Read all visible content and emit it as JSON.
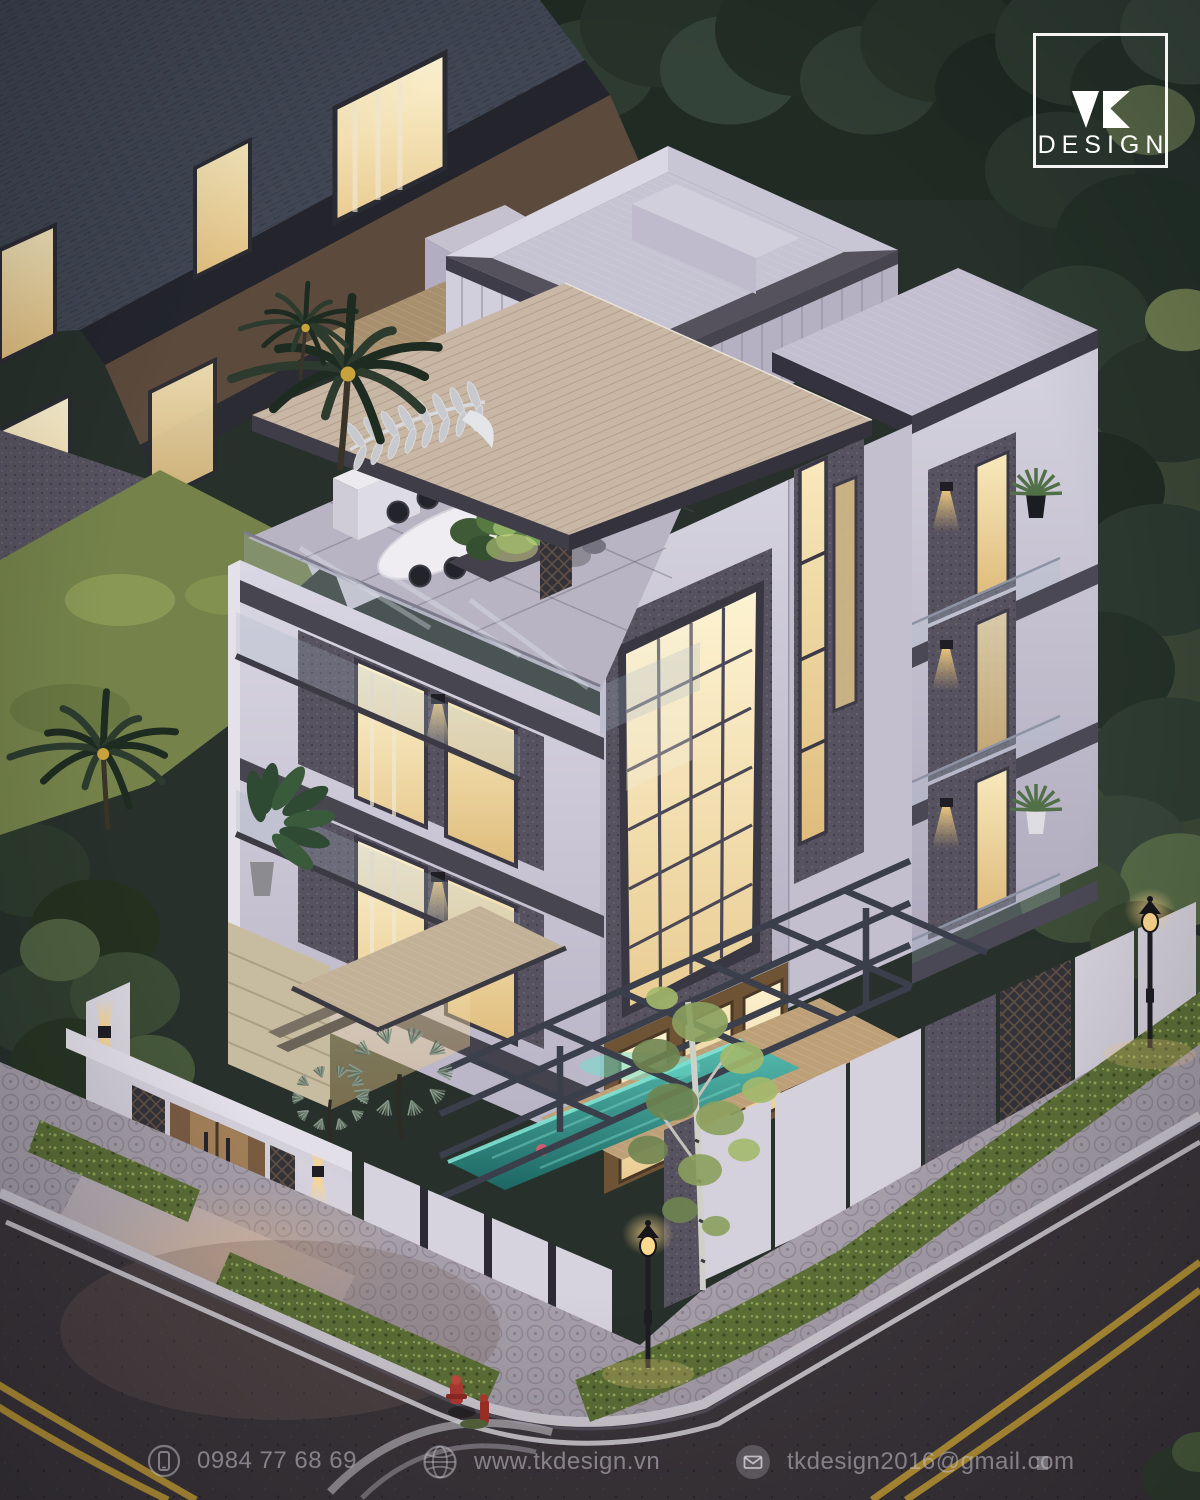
{
  "logo": {
    "mark": "TK",
    "name": "DESIGN"
  },
  "footer": {
    "contacts": [
      {
        "icon": "phone-icon",
        "value": "0984 77 68 69"
      },
      {
        "icon": "globe-icon",
        "value": "www.tkdesign.vn"
      },
      {
        "icon": "email-icon",
        "value": "tkdesign2016@gmail.com"
      }
    ]
  },
  "scene": {
    "time_of_day": "dusk",
    "subject": "Modern four-storey corner villa with rooftop terrace, wood canopy, swimming pool, perimeter wall and street corner with double yellow lines",
    "colors": {
      "wall_white": "#d6d3e1",
      "window_warm": "#f2dfa8",
      "pool_teal": "#3aa79b",
      "foliage_dark": "#2e3d32",
      "road_asphalt": "#3b3539",
      "road_marking_yellow": "#c7a23c",
      "curb_white": "#cfcad2",
      "wood_canopy": "#c9b7a6",
      "stone_dark": "#57525f"
    }
  }
}
